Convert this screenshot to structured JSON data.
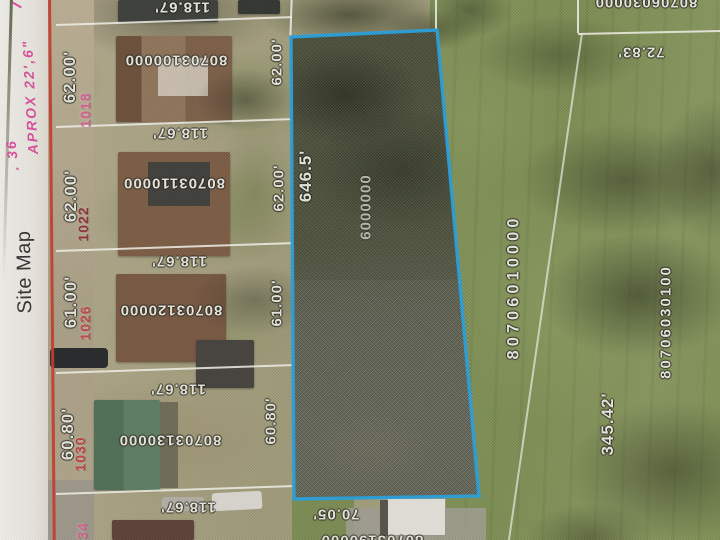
{
  "margin": {
    "handwriting_approx": "APROX 22',6\"",
    "handwriting_num": ". 36",
    "title": "Site Map"
  },
  "top_partial_parcel": {
    "depth": "118.67'"
  },
  "left_parcels": [
    {
      "number": "80703100000",
      "address": "1018",
      "address_color": "#d4628f",
      "width_left": "62.00'",
      "width_right": "62.00'",
      "depth": "118.67'"
    },
    {
      "number": "80703110000",
      "address": "1022",
      "address_color": "#8e3434",
      "width_left": "62.00'",
      "width_right": "62.00'",
      "depth": "118.67'"
    },
    {
      "number": "80703120000",
      "address": "1026",
      "address_color": "#c04848",
      "width_left": "61.00'",
      "width_right": "61.00'",
      "depth": "118.67'"
    },
    {
      "number": "80703130000",
      "address": "1030",
      "address_color": "#c04343",
      "width_left": "60.80'",
      "width_right": "60.80'",
      "depth": "118.67'"
    },
    {
      "address": "34",
      "address_color": "#d4628f",
      "depth": "118.67'"
    }
  ],
  "highlight_parcel": {
    "length_west": "646.5'",
    "number_visible": "6000000"
  },
  "south_parcel": {
    "width_north": "70.05'",
    "number_partial": "80703190000"
  },
  "east_parcel": {
    "number": "80706010000",
    "length_east": "345.42'"
  },
  "far_east_parcel": {
    "number": "80706030100",
    "width_north": "72.83'"
  },
  "northeast_parcel": {
    "number_partial": "80706030000"
  },
  "colors": {
    "highlight_outline": "#27a0dd",
    "red_boundary_line": "#c5392c",
    "handwriting_pink": "#d94f9b"
  }
}
